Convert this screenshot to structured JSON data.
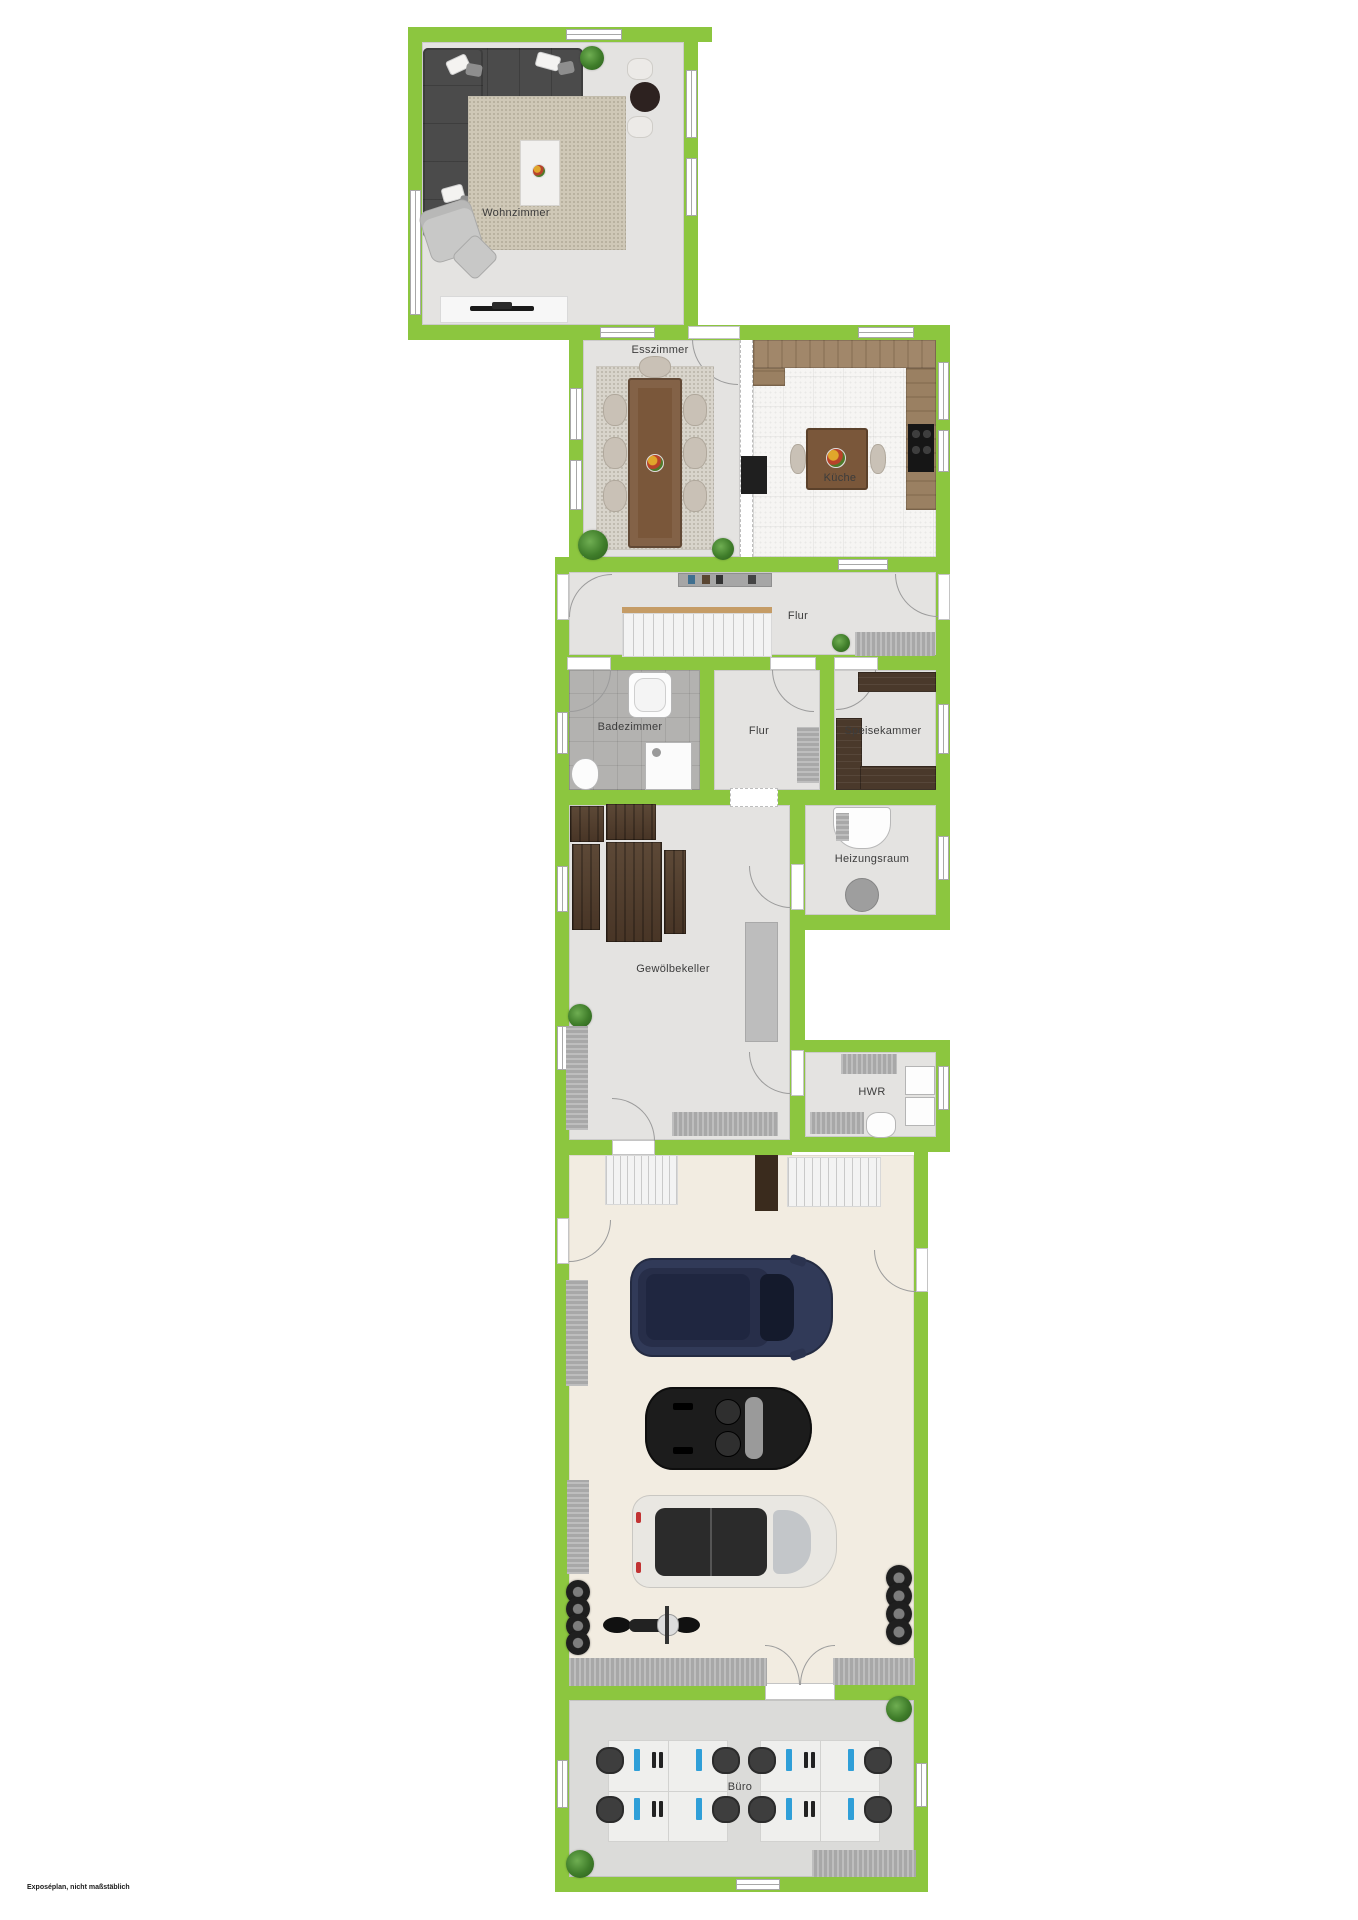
{
  "disclaimer": "Exposéplan, nicht maßstäblich",
  "rooms": {
    "wohnzimmer": "Wohnzimmer",
    "esszimmer": "Esszimmer",
    "kueche": "Küche",
    "flur": "Flur",
    "badezimmer": "Badezimmer",
    "flur2": "Flur",
    "speisekammer": "Speisekammer",
    "heizungsraum": "Heizungsraum",
    "gewoelbekeller": "Gewölbekeller",
    "hwr": "HWR",
    "buero": "Büro"
  },
  "colors": {
    "wall": "#8CC63F",
    "floor": "#E4E3E1",
    "bath_floor": "#B3B2B0",
    "kitchen_floor": "#F6F5F3",
    "garage_floor": "#F2ECE1",
    "office_floor": "#DBDBD9",
    "dark_shelf": "#4A392B",
    "sofa": "#4B4B4B",
    "car_navy": "#313A58",
    "car_black": "#1C1C1C",
    "car_white": "#E9E7E2",
    "screen_blue": "#2F9FD8"
  }
}
